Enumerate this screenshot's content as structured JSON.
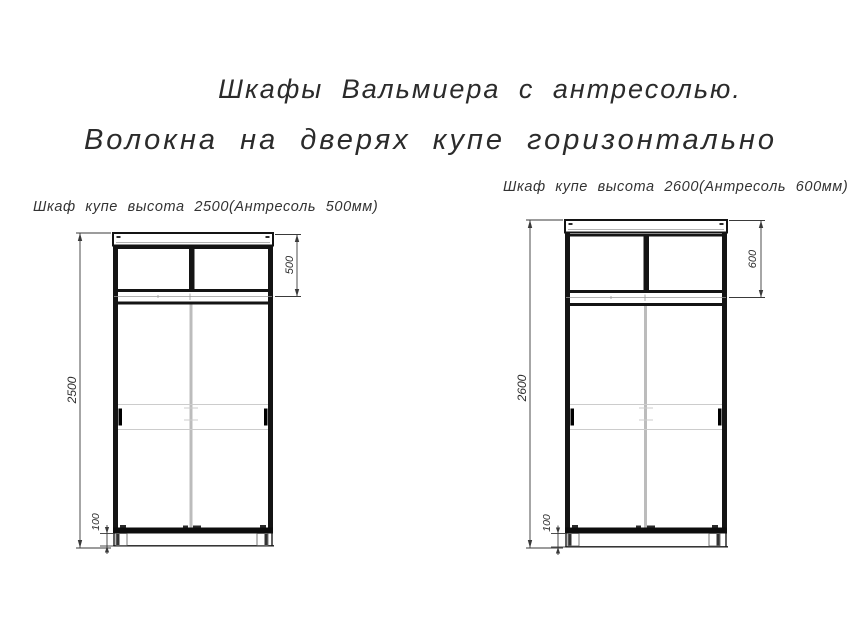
{
  "page": {
    "title_line1": "Шкафы Вальмиера с антресолью.",
    "title_line2": "Волокна на дверях купе горизонтально"
  },
  "left_wardrobe": {
    "caption": "Шкаф купе высота 2500(Антресоль 500мм)",
    "height_mm": "2500",
    "mezzanine_mm": "500",
    "plinth_mm": "100"
  },
  "right_wardrobe": {
    "caption": "Шкаф купе высота 2600(Антресоль 600мм)",
    "height_mm": "2600",
    "mezzanine_mm": "600",
    "plinth_mm": "100"
  },
  "colors": {
    "drawing_line": "#141414",
    "dimension_line": "#3a3a3a",
    "center_divider_gray": "#bcbcbc",
    "door_rail_gray": "#cccccc",
    "text": "#2b2b2b",
    "background": "#ffffff"
  }
}
